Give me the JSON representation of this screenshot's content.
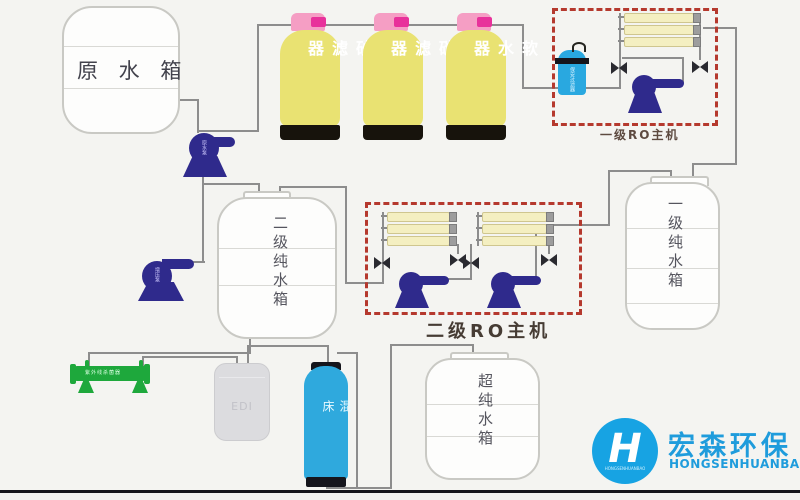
{
  "tanks": {
    "raw": {
      "label": "原 水 箱"
    },
    "secondary_pure": {
      "label": "二级纯水箱"
    },
    "primary_pure": {
      "label": "一级纯水箱"
    },
    "ultra_pure": {
      "label": "超纯水箱"
    }
  },
  "filters": [
    {
      "label": "砂滤器"
    },
    {
      "label": "碳滤器"
    },
    {
      "label": "软水器"
    }
  ],
  "ro_units": {
    "stage1": {
      "label": "一级RO主机"
    },
    "stage2": {
      "label": "二级RO主机"
    }
  },
  "components": {
    "security_filter": {
      "label": "保安过滤器"
    },
    "raw_pump": {
      "label": "原水泵"
    },
    "booster_pump": {
      "label": "增压泵"
    },
    "uv_sterilizer": {
      "label": "紫外线杀菌器"
    },
    "edi": {
      "label": "EDI"
    },
    "mixed_bed": {
      "label": "混床"
    }
  },
  "logo": {
    "mark": "H",
    "arc_text": "HONGSENHUANBAO",
    "cn": "宏森环保",
    "en": "HONGSENHUANBAO"
  },
  "colors": {
    "background": "#f4f4f1",
    "pipe": "#8d8d8d",
    "vessel_yellow": "#e9e272",
    "cap_pink": "#f59ec4",
    "valve_magenta": "#e8319b",
    "pump_navy": "#2f2a8c",
    "ro_border_red": "#b5392e",
    "blue_filter": "#29a8e0",
    "mixed_bed_blue": "#2fa9dd",
    "uv_green": "#1ea83c",
    "logo_blue": "#17a3e3"
  }
}
